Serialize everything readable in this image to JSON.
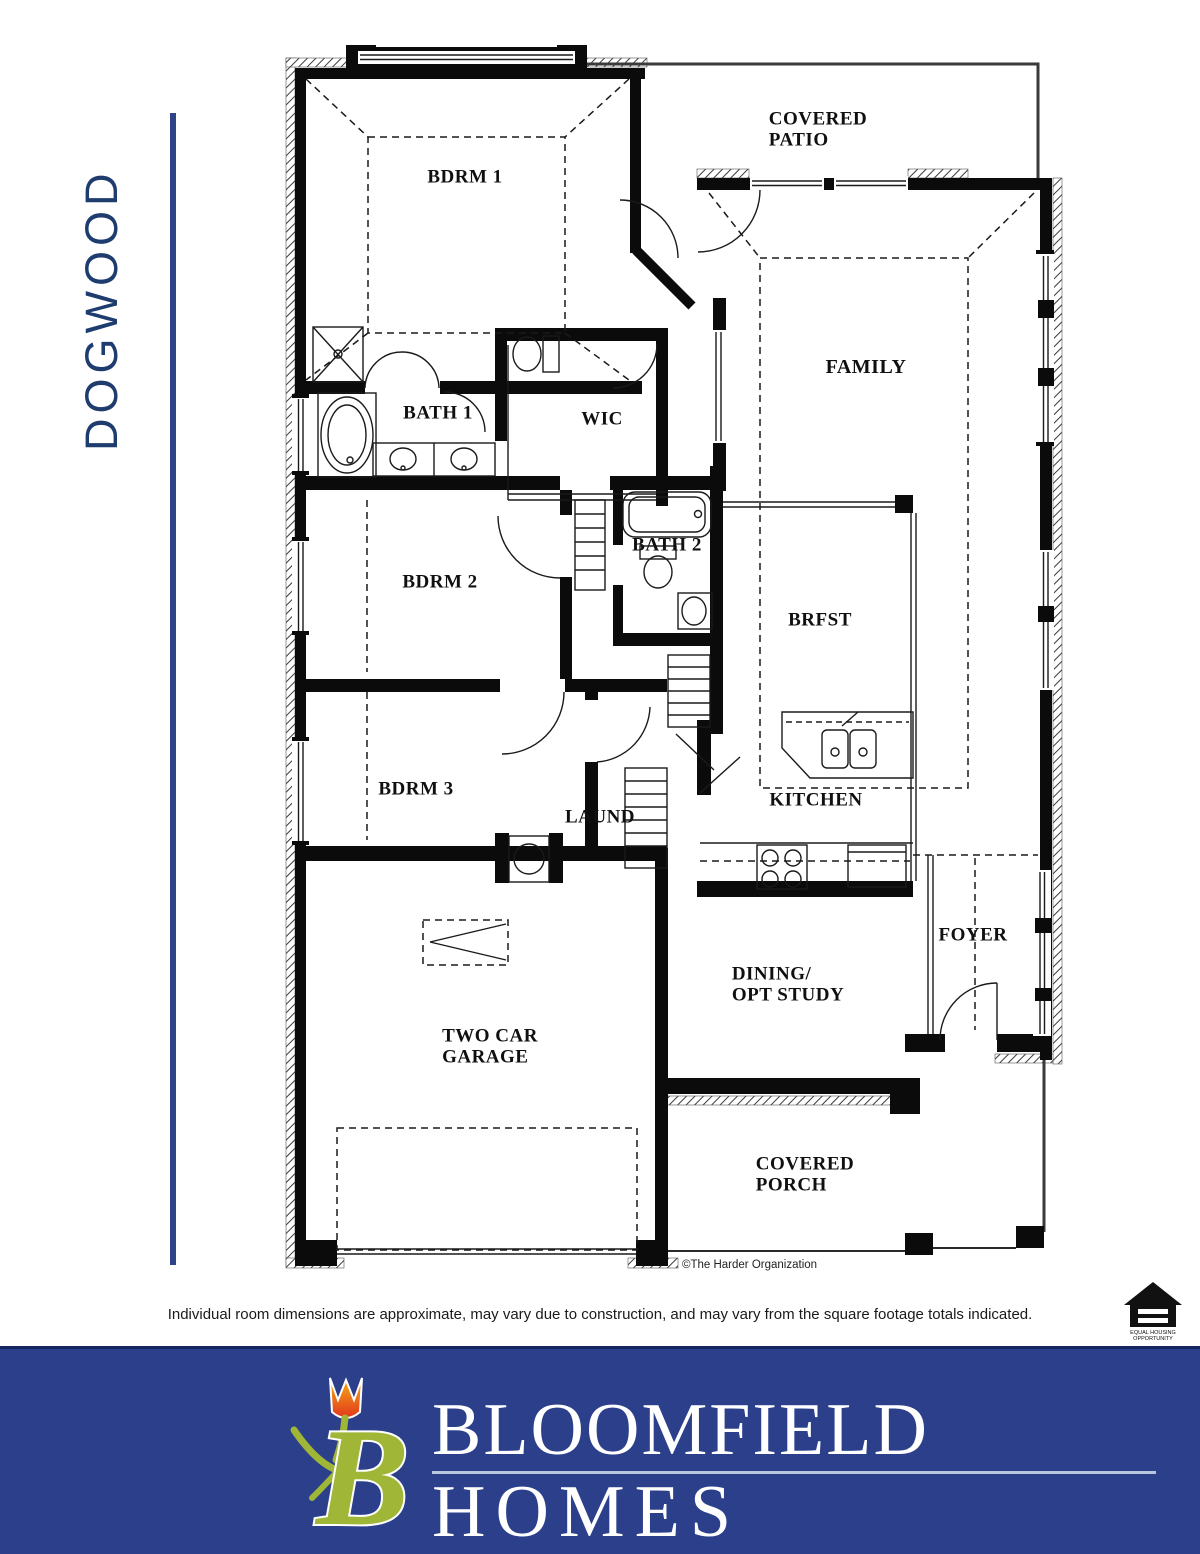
{
  "page": {
    "title_vertical": "DOGWOOD",
    "disclaimer": "Individual room dimensions are approximate, may vary due to construction, and may vary from the square footage totals indicated.",
    "copyright": "©The Harder Organization"
  },
  "rooms": [
    {
      "label": "BDRM 1"
    },
    {
      "label": "COVERED\nPATIO"
    },
    {
      "label": "FAMILY"
    },
    {
      "label": "BATH 1"
    },
    {
      "label": "WIC"
    },
    {
      "label": "BATH 2"
    },
    {
      "label": "BDRM 2"
    },
    {
      "label": "BRFST"
    },
    {
      "label": "BDRM 3"
    },
    {
      "label": "LAUND"
    },
    {
      "label": "KITCHEN"
    },
    {
      "label": "FOYER"
    },
    {
      "label": "DINING/\nOPT STUDY"
    },
    {
      "label": "TWO CAR\nGARAGE"
    },
    {
      "label": "COVERED\nPORCH"
    }
  ],
  "footer": {
    "brand_line1": "BLOOMFIELD",
    "brand_line2": "HOMES",
    "equal_housing_line1": "EQUAL HOUSING",
    "equal_housing_line2": "OPPORTUNITY"
  },
  "colors": {
    "navy_title": "#1e3c6e",
    "banner_blue": "#2b3f8b",
    "logo_green": "#9fb637",
    "tulip_orange": "#f5a31a",
    "tulip_red": "#e0361c"
  }
}
